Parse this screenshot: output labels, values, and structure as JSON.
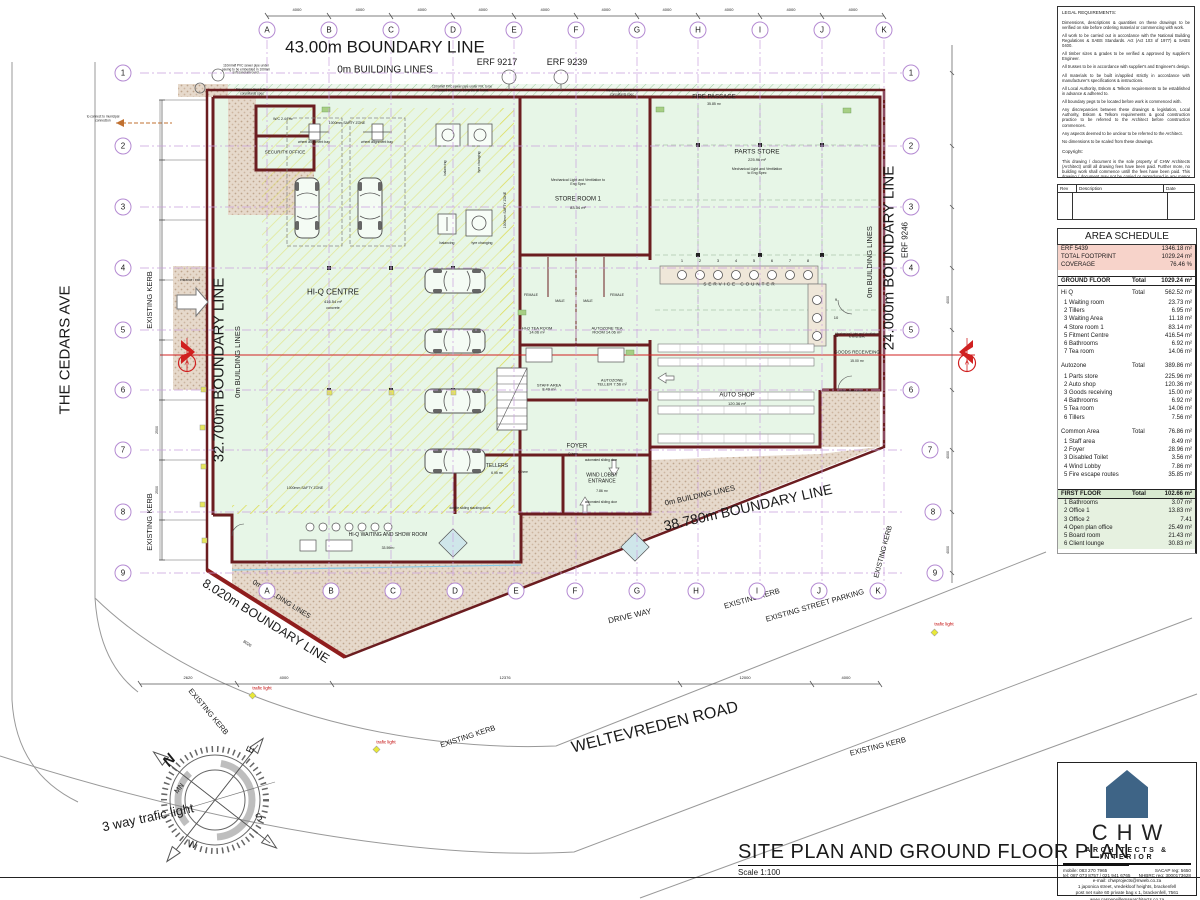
{
  "sheet": {
    "title": "SITE PLAN AND GROUND FLOOR PLAN",
    "scale": "Scale 1:100"
  },
  "legal": {
    "title": "LEGAL REQUIREMENTS:",
    "paragraphs": [
      "Dimensions, descriptions & quantities on these drawings to be verified on site before ordering material or commencing with work.",
      "All work to be carried out in accordance with the National Building Regulations & SABS Standards. Act (Act 103 of 1977) & SABS 0400.",
      "All timber sizes & grades to be verified & approved by supplier's Engineer.",
      "All trusses to be in accordance with supplier's and Engineer's design.",
      "All materials to be built in/applied strictly in accordance with manufacturer's specifications & instructions.",
      "All Local Authority, Eskom & Telkom requirements to be established in advance & adhered to.",
      "All boundary pegs to be located before work is commenced with.",
      "Any discrepancies between these drawings & legislation, Local Authority, Eskom & Telkom requirements & good construction practice to be referred to the Architect before construction commences.",
      "Any aspects deemed to be unclear to be referred to the Architect.",
      "No dimensions to be scaled from these drawings."
    ],
    "copyright_title": "Copyright:",
    "copyright_text": "This drawing / document is the sole property of CHW Architects (Architect) untill all drawing fees have been paid. Further more, no building work shall commence untill the fees have been paid. This drawing / document may not be copied or reproduced in any manor whatsoever without the written consent from CHW Architects",
    "rev_headers": [
      "Rev",
      "Description",
      "Date"
    ]
  },
  "area_schedule": {
    "title": "AREA SCHEDULE",
    "summary": [
      [
        "ERF 5439",
        "1346.18 m²"
      ],
      [
        "TOTAL FOOTPRINT",
        "1029.24 m²"
      ],
      [
        "COVERAGE",
        "76.46 %"
      ]
    ],
    "ground_floor": {
      "label": "GROUND FLOOR",
      "total_label": "Total",
      "total": "1029.24 m²",
      "groups": [
        {
          "name": "Hi Q",
          "total_label": "Total",
          "total": "562.52 m²",
          "items": [
            [
              "1 Waiting room",
              "23.73 m²"
            ],
            [
              "2 Tillers",
              "6.95 m²"
            ],
            [
              "3 Waiting Area",
              "11.18 m²"
            ],
            [
              "4 Store room 1",
              "83.14 m²"
            ],
            [
              "5 Fitment Centre",
              "416.54 m²"
            ],
            [
              "6 Bathrooms",
              "6.92 m²"
            ],
            [
              "7 Tea room",
              "14.06 m²"
            ]
          ]
        },
        {
          "name": "Autozone",
          "total_label": "Total",
          "total": "389.86 m²",
          "items": [
            [
              "1 Parts store",
              "225.96 m²"
            ],
            [
              "2 Auto shop",
              "120.36 m²"
            ],
            [
              "3 Goods receiving",
              "15.00 m²"
            ],
            [
              "4 Bathrooms",
              "6.92 m²"
            ],
            [
              "5 Tea room",
              "14.06 m²"
            ],
            [
              "6 Tillers",
              "7.56 m²"
            ]
          ]
        },
        {
          "name": "Common Area",
          "total_label": "Total",
          "total": "76.86 m²",
          "items": [
            [
              "1 Staff area",
              "8.49 m²"
            ],
            [
              "2 Foyer",
              "28.96 m²"
            ],
            [
              "3 Disabled Toilet",
              "3.56 m²"
            ],
            [
              "4 Wind Lobby",
              "7.86 m²"
            ],
            [
              "5 Fire escape routes",
              "35.85 m²"
            ]
          ]
        }
      ]
    },
    "first_floor": {
      "label": "FIRST FLOOR",
      "total_label": "Total",
      "total": "102.66 m²",
      "items": [
        [
          "1 Bathrooms",
          "3.07 m²"
        ],
        [
          "2 Office 1",
          "13.83 m²"
        ],
        [
          "3 Office 2",
          "7.41"
        ],
        [
          "4 Open plan office",
          "25.49 m²"
        ],
        [
          "5 Board room",
          "21.43 m²"
        ],
        [
          "6 Client lounge",
          "30.83 m²"
        ]
      ]
    }
  },
  "title_block": {
    "logo_text": "CHW",
    "logo_sub": "ARCHITECTS & INTERIOR",
    "logo_color": "#3e6486",
    "row1_left": "mobile: 083 270 7965",
    "row1_right": "SACAP reg: 5650",
    "row2_left": "tel: 087 073 8757 / 021 941 6765",
    "row2_right": "NHBRC reg: 3000173628",
    "lines": [
      "e-mail: chwprojects@mweb.co.za",
      "1 japonica street, vredekloof heights, brackenfell",
      "post net suite 60 private bag x 1, brackenfell, 7561",
      "www.casperwillemsearchitects.co.za",
      "@ chwarchitects / f chw architects",
      "casper willemse architects pty (ltd) 2017/213116/07"
    ]
  },
  "grid": {
    "letters": [
      "A",
      "B",
      "C",
      "D",
      "E",
      "F",
      "G",
      "H",
      "I",
      "J",
      "K"
    ],
    "numbers": [
      "1",
      "2",
      "3",
      "4",
      "5",
      "6",
      "7",
      "8",
      "9"
    ]
  },
  "dims": {
    "top": "4000",
    "bottom": [
      "2620",
      "4000",
      "12376",
      "12000",
      "4000"
    ],
    "left": "2500",
    "right": "4000",
    "sw": "8020"
  },
  "section_marker": "A",
  "compass": {
    "labels": {
      "n": "N",
      "mn": "MN",
      "e": "E",
      "s": "S",
      "w": "W"
    }
  },
  "counter_numbers": [
    "1",
    "2",
    "3",
    "4",
    "5",
    "6",
    "7",
    "8",
    "9",
    "10",
    "11"
  ],
  "plan_labels": {
    "boundary_top": "43.00m BOUNDARY LINE",
    "building_top": "0m BUILDING LINES",
    "erf9217": "ERF 9217",
    "erf9239": "ERF 9239",
    "cedars": "THE CEDARS AVE",
    "b_left": "32.700m BOUNDARY LINE",
    "bl_left": "0m BUILDING LINES",
    "kerb_l1": "EXISTING KERB",
    "kerb_l2": "EXISTING KERB",
    "b_right": "24.000m BOUNDARY LINE",
    "bl_right": "0m BUILDING LINES",
    "erf9246": "ERF 9246",
    "kerb_r": "EXISTING KERB",
    "b_se": "38.780m BOUNDARY LINE",
    "bl_se": "0m BUILDING LINES",
    "b_sw": "8.020m BOUNDARY LINE",
    "bl_sw": "0m BUILDING LINES",
    "driveway": "DRIVE WAY",
    "kerb_d1": "EXISTING KERB",
    "parking": "EXISTING STREET PARKING",
    "kerb_d2": "EXISTING KERB",
    "kerb_c1": "EXISTING KERB",
    "kerb_c2": "EXISTING KERB",
    "welte": "WELTEVREDEN ROAD",
    "t3way": "3 way trafic light",
    "traffic1": "trafic light",
    "traffic2": "trafic light",
    "traffic3": "trafic light",
    "fire_passage": "FIRE PASSAGE",
    "fp_area": "35.85 m²",
    "security": "SECURITY OFFICE",
    "wc": "W/C  2.44 m²",
    "hiq": "HI-Q CENTRE",
    "hiq_a": "416.54 m²",
    "hiq_c": "concrete",
    "bay1": "wheel alignment bay",
    "bay2": "wheel alignment bay",
    "bal1": "balancing",
    "tyre1": "tyre changing",
    "bal2": "balancing",
    "tyre2": "tyre changing",
    "store1": "STORE ROOM 1",
    "store1_a": "83.54 m²",
    "mech1": "Mechanical Light and Ventilation to Eng Spec",
    "parts": "PARTS STORE",
    "parts_a": "225.96 m²",
    "mech2": "Mechanical Light and Ventilation to Eng Spec",
    "female1": "FEMALE",
    "male1": "MALE",
    "male2": "MALE",
    "female2": "FEMALE",
    "hiq_tea": "HI-Q TEA ROOM 14.06 m²",
    "auto_tea": "AUTOZONE TEA ROOM 14.06 m²",
    "staff": "STAFF AREA 8.49 m²",
    "az_tel": "AUTOZONE TELLER 7.56 m²",
    "foyer": "FOYER",
    "tellers": "TELLERS",
    "tellers_a": "6.95 m²",
    "wind": "WIND LOBBY ENTRANCE",
    "wind_a": "7.86 m²",
    "show": "HI-Q WAITING AND SHOW ROOM",
    "show_a": "33.59m²",
    "autoshop": "AUTO SHOP",
    "autoshop_a": "120.36 m²",
    "goods": "GOODS RECEIVEING",
    "goods_a": "15.00 m²",
    "mech3": "Mechanical Light and Ventilation to Eng Spec",
    "roller": "roller shutter door",
    "svc": "SERVICE COUNTER",
    "safety1": "1000mm SAFTY ZONE",
    "safety2": "1000mm SAFTY ZONE",
    "safety3": "1000mm SAFTY ZONE",
    "sewer1": "110mmØ PVC sewer pipe under paving to be embedded in 100mm soft sand all round.",
    "sewer2": "110mmØ PVC sewer pipe under FFL to be encased in 100mm concrete all round.",
    "municipal": "to connect to municipal connection",
    "ent": "entrance / exit",
    "stack": "double sliding stacking doors",
    "slide1": "automated sliding door",
    "slide2": "automated sliding door",
    "fe1": "fire escape door to the consultants spec",
    "fe2": "fire escape door to the consultants spec",
    "qh1": "Q-here",
    "qh2": "Q-here"
  }
}
